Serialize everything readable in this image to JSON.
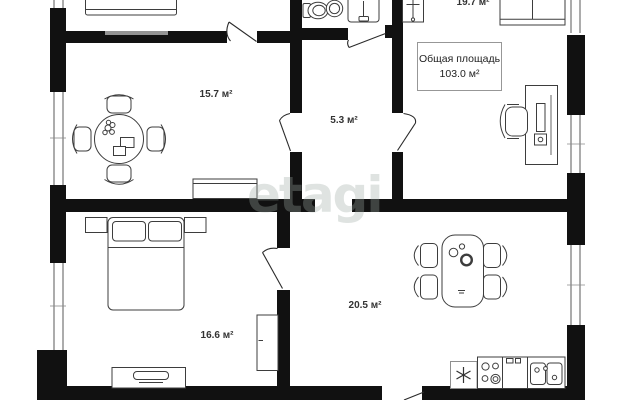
{
  "watermark": "etagi",
  "summary": {
    "title": "Общая площадь",
    "value": "103.0 м²"
  },
  "rooms": [
    {
      "name": "room-top-left",
      "label": "15.7 м²"
    },
    {
      "name": "hallway",
      "label": "5.3 м²"
    },
    {
      "name": "room-top-right",
      "label": "19.7 м²"
    },
    {
      "name": "bedroom",
      "label": "16.6 м²"
    },
    {
      "name": "kitchen-living-room",
      "label": "20.5 м²"
    }
  ],
  "colors": {
    "wall": "#111111",
    "furniture_outline": "#3d3d3d",
    "watermark": "rgba(158,170,164,0.33)",
    "background": "#ffffff"
  },
  "icons": [
    "toilet-icon",
    "washbasin-icon",
    "shower-cabin-icon",
    "coat-rack-icon",
    "wardrobe-icon",
    "desk-icon",
    "office-chair-icon",
    "round-dining-table-icon",
    "chair-icon",
    "bed-icon",
    "nightstand-icon",
    "tv-stand-icon",
    "tv-cabinet-icon",
    "dining-table-icon",
    "fridge-icon",
    "stove-icon",
    "kitchen-cabinet-icon",
    "kitchen-sink-icon",
    "window-icon",
    "door-swing-icon"
  ]
}
